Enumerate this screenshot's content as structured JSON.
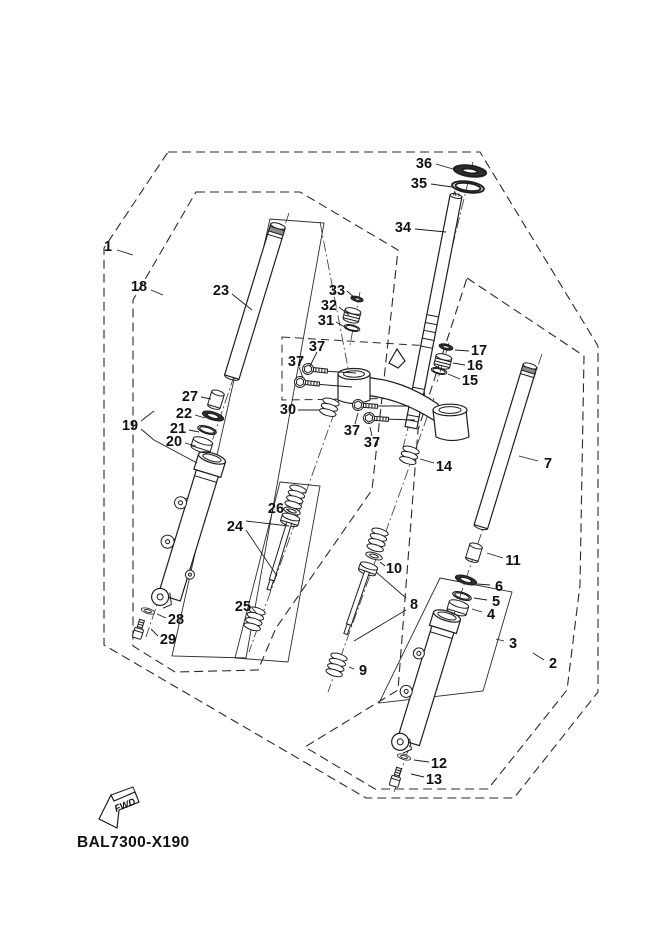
{
  "diagram": {
    "code_label": "BAL7300-X190",
    "fwd_label": "FWD",
    "colors": {
      "background": "#ffffff",
      "line": "#1d1d1d"
    },
    "callouts": [
      {
        "label": "1",
        "x": 108,
        "y": 246,
        "leaders": [
          [
            117,
            250,
            133,
            255
          ]
        ]
      },
      {
        "label": "18",
        "x": 139,
        "y": 286,
        "leaders": [
          [
            151,
            290,
            163,
            295
          ]
        ]
      },
      {
        "label": "23",
        "x": 221,
        "y": 290,
        "leaders": [
          [
            232,
            294,
            252,
            310
          ]
        ]
      },
      {
        "label": "27",
        "x": 190,
        "y": 396,
        "leaders": [
          [
            201,
            397,
            211,
            399
          ]
        ]
      },
      {
        "label": "22",
        "x": 184,
        "y": 413,
        "leaders": [
          [
            195,
            415,
            205,
            418
          ]
        ]
      },
      {
        "label": "21",
        "x": 178,
        "y": 428,
        "leaders": [
          [
            189,
            430,
            199,
            432
          ]
        ]
      },
      {
        "label": "20",
        "x": 174,
        "y": 441,
        "leaders": [
          [
            185,
            443,
            196,
            446
          ]
        ]
      },
      {
        "label": "19",
        "x": 130,
        "y": 425,
        "leaders": [
          [
            141,
            421,
            154,
            411
          ],
          [
            141,
            429,
            154,
            440
          ],
          [
            154,
            440,
            197,
            463
          ]
        ]
      },
      {
        "label": "28",
        "x": 176,
        "y": 619,
        "leaders": [
          [
            166,
            618,
            157,
            614
          ]
        ]
      },
      {
        "label": "29",
        "x": 168,
        "y": 639,
        "leaders": [
          [
            158,
            636,
            151,
            629
          ]
        ]
      },
      {
        "label": "24",
        "x": 235,
        "y": 526,
        "leaders": [
          [
            246,
            521,
            289,
            526
          ],
          [
            246,
            530,
            277,
            576
          ]
        ]
      },
      {
        "label": "25",
        "x": 243,
        "y": 606,
        "leaders": [
          [
            252,
            608,
            257,
            614
          ]
        ]
      },
      {
        "label": "26",
        "x": 276,
        "y": 508,
        "leaders": [
          [
            286,
            509,
            291,
            512
          ]
        ]
      },
      {
        "label": "30",
        "x": 288,
        "y": 409,
        "leaders": [
          [
            298,
            410,
            320,
            410
          ]
        ]
      },
      {
        "label": "31",
        "x": 326,
        "y": 320,
        "leaders": [
          [
            336,
            322,
            350,
            330
          ]
        ]
      },
      {
        "label": "32",
        "x": 329,
        "y": 305,
        "leaders": [
          [
            339,
            307,
            349,
            315
          ]
        ]
      },
      {
        "label": "33",
        "x": 337,
        "y": 290,
        "leaders": [
          [
            347,
            291,
            356,
            299
          ]
        ]
      },
      {
        "label": "37",
        "x": 317,
        "y": 346,
        "leaders": [
          [
            317,
            352,
            310,
            366
          ]
        ]
      },
      {
        "label": "37",
        "x": 296,
        "y": 361,
        "leaders": [
          [
            299,
            367,
            303,
            378
          ]
        ]
      },
      {
        "label": "37",
        "x": 352,
        "y": 430,
        "leaders": [
          [
            355,
            424,
            358,
            413
          ]
        ]
      },
      {
        "label": "37",
        "x": 372,
        "y": 442,
        "leaders": [
          [
            372,
            436,
            370,
            427
          ]
        ]
      },
      {
        "label": "34",
        "x": 403,
        "y": 227,
        "leaders": [
          [
            415,
            229,
            446,
            232
          ]
        ]
      },
      {
        "label": "35",
        "x": 419,
        "y": 183,
        "leaders": [
          [
            431,
            184,
            452,
            187
          ]
        ]
      },
      {
        "label": "36",
        "x": 424,
        "y": 163,
        "leaders": [
          [
            436,
            164,
            453,
            169
          ]
        ]
      },
      {
        "label": "17",
        "x": 479,
        "y": 350,
        "leaders": [
          [
            469,
            351,
            455,
            350
          ]
        ]
      },
      {
        "label": "16",
        "x": 475,
        "y": 365,
        "leaders": [
          [
            465,
            365,
            453,
            363
          ]
        ]
      },
      {
        "label": "15",
        "x": 470,
        "y": 380,
        "leaders": [
          [
            460,
            379,
            448,
            374
          ]
        ]
      },
      {
        "label": "14",
        "x": 444,
        "y": 466,
        "leaders": [
          [
            434,
            463,
            420,
            459
          ]
        ]
      },
      {
        "label": "7",
        "x": 548,
        "y": 463,
        "leaders": [
          [
            538,
            461,
            519,
            456
          ]
        ]
      },
      {
        "label": "11",
        "x": 513,
        "y": 560,
        "leaders": [
          [
            503,
            558,
            487,
            553
          ]
        ]
      },
      {
        "label": "6",
        "x": 499,
        "y": 586,
        "leaders": [
          [
            490,
            585,
            477,
            584
          ]
        ]
      },
      {
        "label": "5",
        "x": 496,
        "y": 601,
        "leaders": [
          [
            487,
            600,
            474,
            598
          ]
        ]
      },
      {
        "label": "4",
        "x": 491,
        "y": 614,
        "leaders": [
          [
            482,
            612,
            472,
            609
          ]
        ]
      },
      {
        "label": "3",
        "x": 513,
        "y": 643,
        "leaders": [
          [
            504,
            641,
            496,
            639
          ]
        ]
      },
      {
        "label": "2",
        "x": 553,
        "y": 663,
        "leaders": [
          [
            544,
            660,
            533,
            653
          ]
        ]
      },
      {
        "label": "10",
        "x": 394,
        "y": 568,
        "leaders": [
          [
            385,
            566,
            380,
            562
          ]
        ]
      },
      {
        "label": "8",
        "x": 414,
        "y": 604,
        "leaders": [
          [
            406,
            598,
            376,
            572
          ],
          [
            406,
            610,
            354,
            641
          ]
        ]
      },
      {
        "label": "9",
        "x": 363,
        "y": 670,
        "leaders": [
          [
            354,
            669,
            349,
            667
          ]
        ]
      },
      {
        "label": "12",
        "x": 439,
        "y": 763,
        "leaders": [
          [
            429,
            762,
            414,
            760
          ]
        ]
      },
      {
        "label": "13",
        "x": 434,
        "y": 779,
        "leaders": [
          [
            424,
            777,
            411,
            774
          ]
        ]
      }
    ]
  }
}
